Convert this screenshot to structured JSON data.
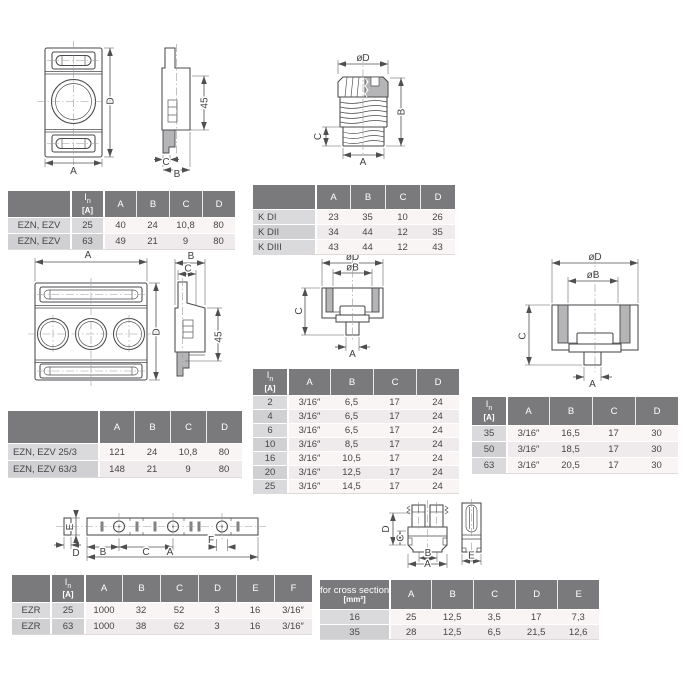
{
  "page": {
    "background": "#ffffff"
  },
  "colors": {
    "table_header": "#7a7a7c",
    "table_label_col": "#dadadc",
    "row_light": "#faf5f5",
    "row_dark": "#efeaeb",
    "line": "#4a4a4c",
    "section_fill": "#b5b5b7"
  },
  "drawings": {
    "ezn_single": {
      "dim_a": "A",
      "dim_d": "D",
      "dim_45": "45",
      "dim_c": "C",
      "dim_b": "B"
    },
    "kd_cap": {
      "dim_od": "øD",
      "dim_b": "B",
      "dim_c": "C",
      "dim_a": "A"
    },
    "ezn_3pole": {
      "dim_a": "A",
      "dim_b": "B",
      "dim_c": "C",
      "dim_d": "D",
      "dim_45": "45"
    },
    "adapter_small": {
      "dim_od": "øD",
      "dim_ob": "øB",
      "dim_c": "C",
      "dim_a": "A"
    },
    "adapter_large": {
      "dim_od": "øD",
      "dim_ob": "øB",
      "dim_c": "C",
      "dim_a": "A"
    },
    "busbar": {
      "dim_e": "E",
      "dim_d": "D",
      "dim_b": "B",
      "dim_c": "C",
      "dim_f": "F",
      "dim_a": "A"
    },
    "clamp": {
      "dim_d": "D",
      "dim_c": "C",
      "dim_b": "B",
      "dim_a": "A",
      "dim_e": "E"
    }
  },
  "tables": {
    "ezn": {
      "in_sym": "I",
      "in_sub": "n",
      "in_unit": "[A]",
      "cols": [
        "A",
        "B",
        "C",
        "D"
      ],
      "rows": [
        {
          "name": "EZN, EZV",
          "in": "25",
          "v": [
            "40",
            "24",
            "10,8",
            "80"
          ]
        },
        {
          "name": "EZN, EZV",
          "in": "63",
          "v": [
            "49",
            "21",
            "9",
            "80"
          ]
        }
      ]
    },
    "kd": {
      "cols": [
        "A",
        "B",
        "C",
        "D"
      ],
      "rows": [
        {
          "name": "K DI",
          "v": [
            "23",
            "35",
            "10",
            "26"
          ]
        },
        {
          "name": "K DII",
          "v": [
            "34",
            "44",
            "12",
            "35"
          ]
        },
        {
          "name": "K DIII",
          "v": [
            "43",
            "44",
            "12",
            "43"
          ]
        }
      ]
    },
    "ezn3": {
      "cols": [
        "A",
        "B",
        "C",
        "D"
      ],
      "rows": [
        {
          "name": "EZN, EZV 25/3",
          "v": [
            "121",
            "24",
            "10,8",
            "80"
          ]
        },
        {
          "name": "EZN, EZV 63/3",
          "v": [
            "148",
            "21",
            "9",
            "80"
          ]
        }
      ]
    },
    "d01": {
      "in_sym": "I",
      "in_sub": "n",
      "in_unit": "[A]",
      "cols": [
        "A",
        "B",
        "C",
        "D"
      ],
      "rows": [
        {
          "in": "2",
          "v": [
            "3/16″",
            "6,5",
            "17",
            "24"
          ]
        },
        {
          "in": "4",
          "v": [
            "3/16″",
            "6,5",
            "17",
            "24"
          ]
        },
        {
          "in": "6",
          "v": [
            "3/16″",
            "6,5",
            "17",
            "24"
          ]
        },
        {
          "in": "10",
          "v": [
            "3/16″",
            "8,5",
            "17",
            "24"
          ]
        },
        {
          "in": "16",
          "v": [
            "3/16″",
            "10,5",
            "17",
            "24"
          ]
        },
        {
          "in": "20",
          "v": [
            "3/16″",
            "12,5",
            "17",
            "24"
          ]
        },
        {
          "in": "25",
          "v": [
            "3/16″",
            "14,5",
            "17",
            "24"
          ]
        }
      ]
    },
    "d02": {
      "in_sym": "I",
      "in_sub": "n",
      "in_unit": "[A]",
      "cols": [
        "A",
        "B",
        "C",
        "D"
      ],
      "rows": [
        {
          "in": "35",
          "v": [
            "3/16″",
            "16,5",
            "17",
            "30"
          ]
        },
        {
          "in": "50",
          "v": [
            "3/16″",
            "18,5",
            "17",
            "30"
          ]
        },
        {
          "in": "63",
          "v": [
            "3/16″",
            "20,5",
            "17",
            "30"
          ]
        }
      ]
    },
    "ezr": {
      "in_sym": "I",
      "in_sub": "n",
      "in_unit": "[A]",
      "cols": [
        "A",
        "B",
        "C",
        "D",
        "E",
        "F"
      ],
      "rows": [
        {
          "name": "EZR",
          "in": "25",
          "v": [
            "1000",
            "32",
            "52",
            "3",
            "16",
            "3/16″"
          ]
        },
        {
          "name": "EZR",
          "in": "63",
          "v": [
            "1000",
            "38",
            "62",
            "3",
            "16",
            "3/16″"
          ]
        }
      ]
    },
    "cross": {
      "head_line1": "for cross section",
      "head_line2": "[mm²]",
      "cols": [
        "A",
        "B",
        "C",
        "D",
        "E"
      ],
      "rows": [
        {
          "name": "16",
          "v": [
            "25",
            "12,5",
            "3,5",
            "17",
            "7,3"
          ]
        },
        {
          "name": "35",
          "v": [
            "28",
            "12,5",
            "6,5",
            "21,5",
            "12,6"
          ]
        }
      ]
    }
  }
}
